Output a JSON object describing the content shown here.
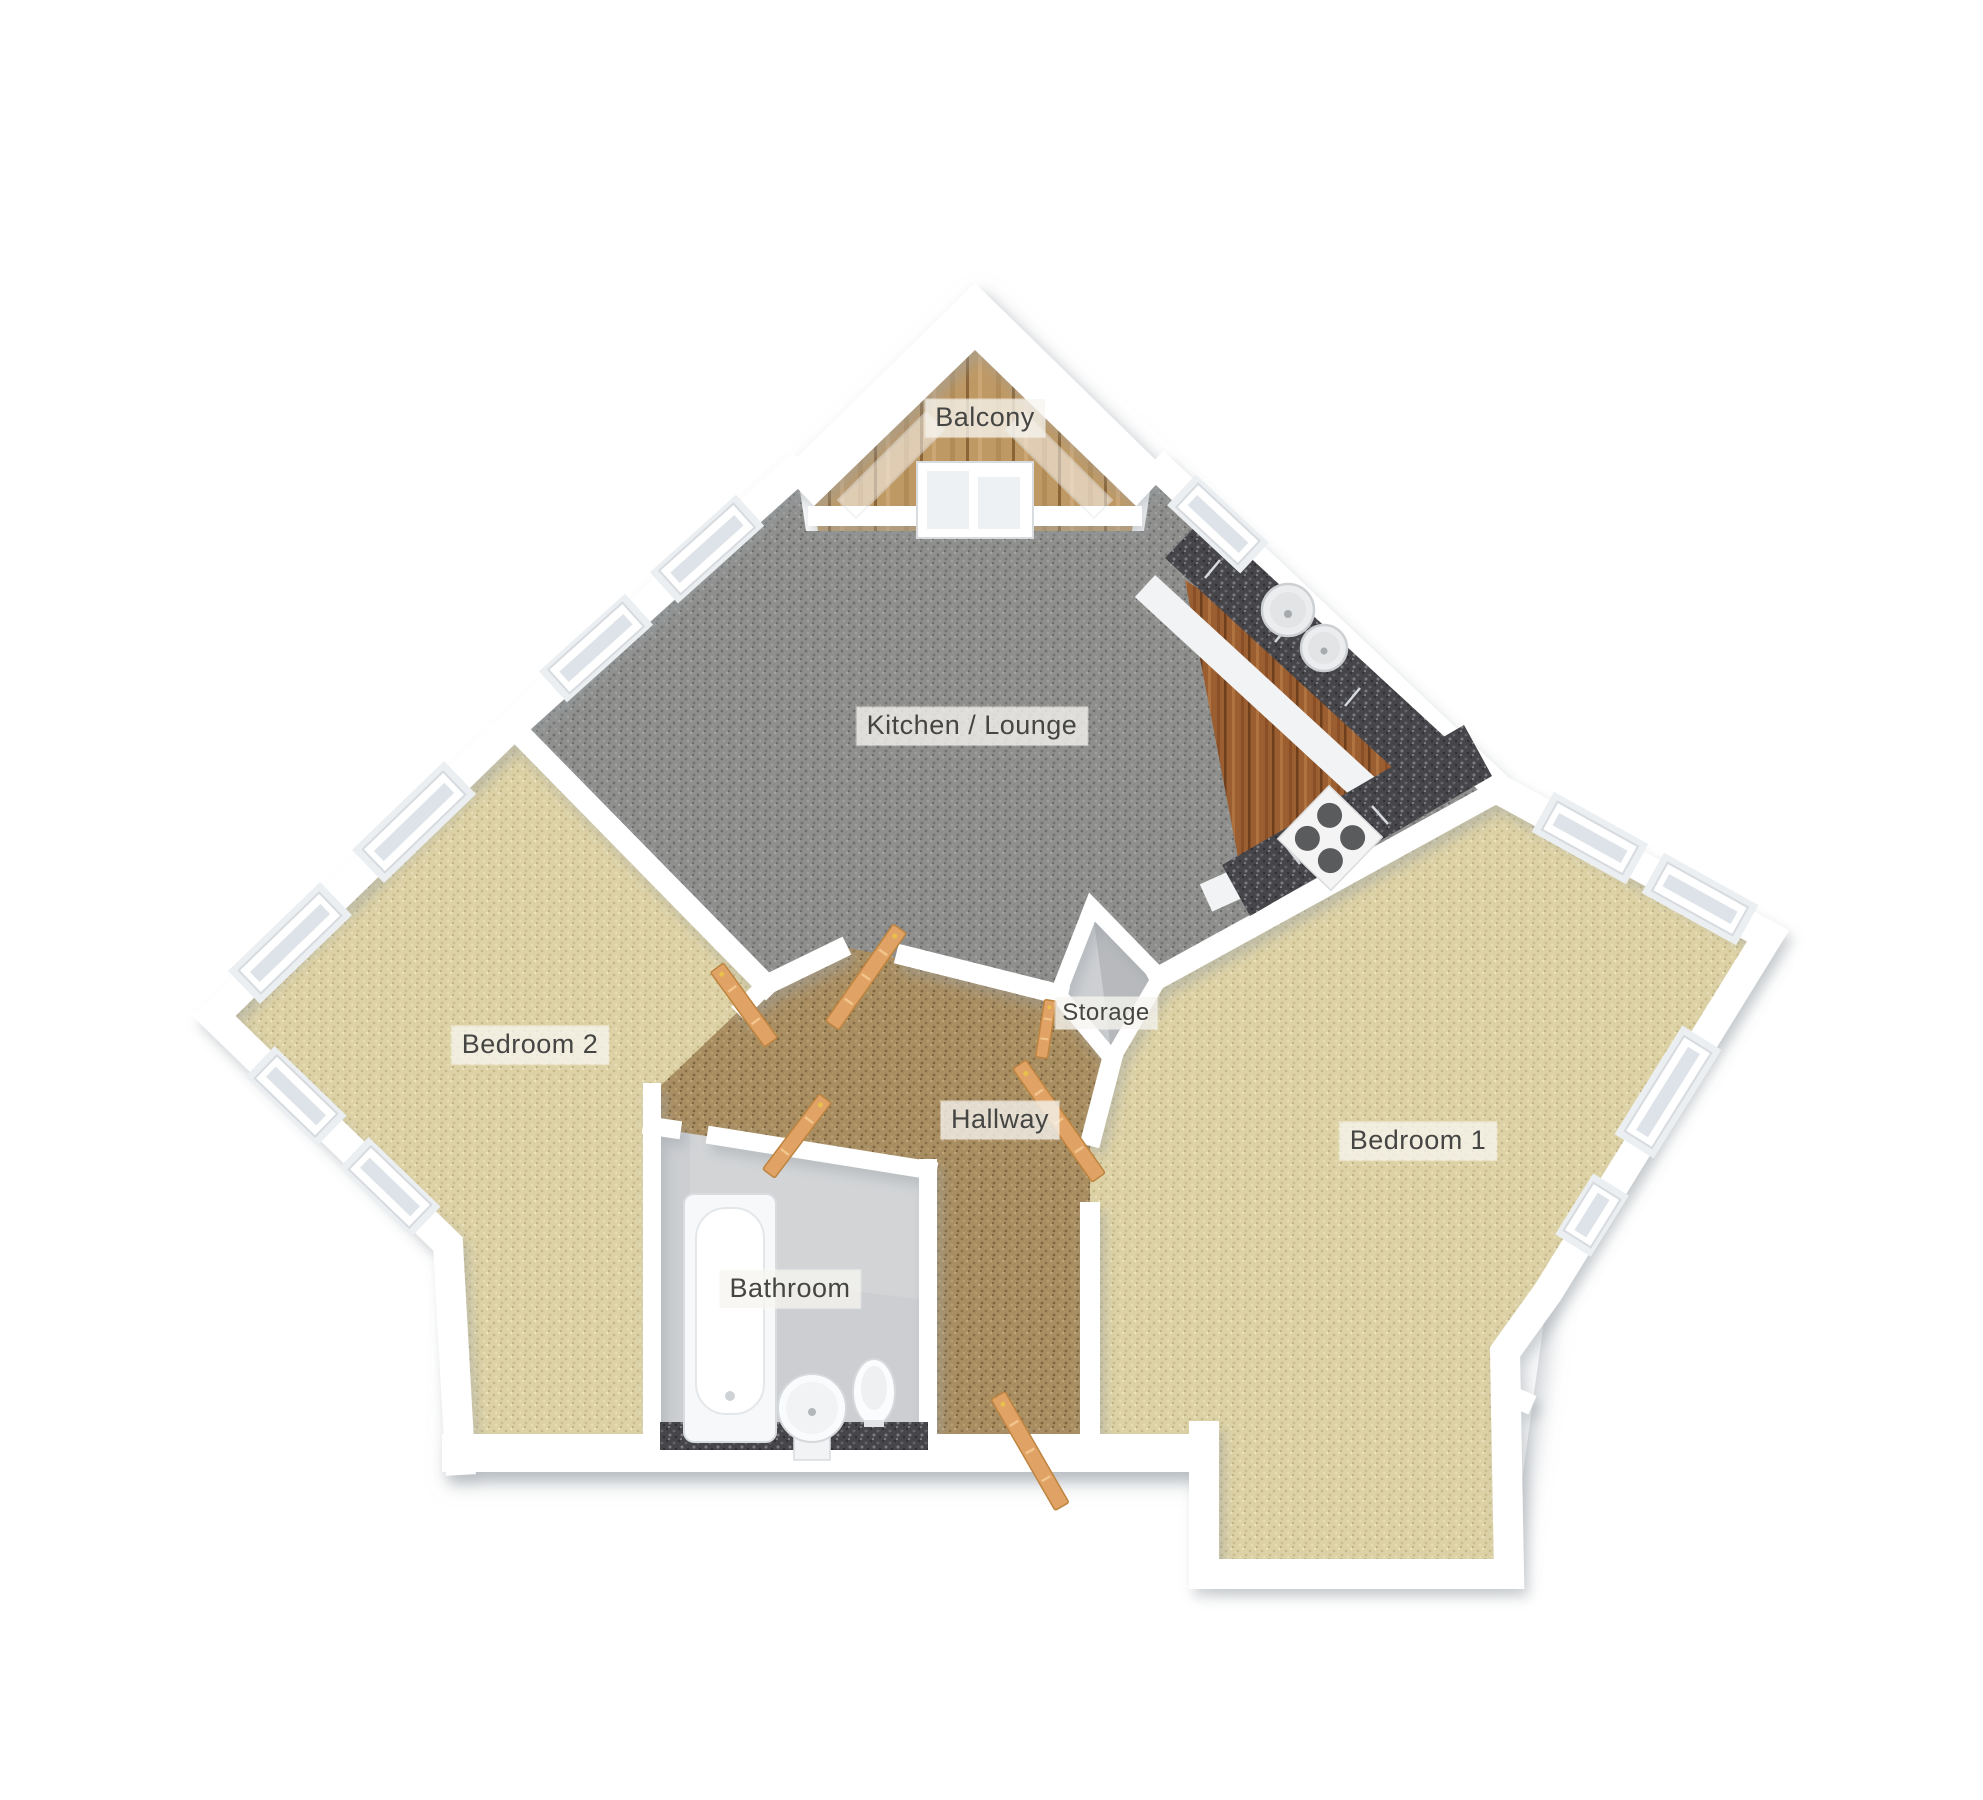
{
  "plan": {
    "type": "3d-floorplan",
    "rooms": {
      "balcony": {
        "label": "Balcony"
      },
      "kitchen_lounge": {
        "label": "Kitchen / Lounge"
      },
      "storage": {
        "label": "Storage"
      },
      "hallway": {
        "label": "Hallway"
      },
      "bedroom2": {
        "label": "Bedroom 2"
      },
      "bedroom1": {
        "label": "Bedroom 1"
      },
      "bathroom": {
        "label": "Bathroom"
      }
    },
    "colors": {
      "background": "#ffffff",
      "wall": "#ffffff",
      "wall_shadow": "#b9bec4",
      "carpet_lounge": "#8f8f8d",
      "carpet_bedroom": "#ddd2a6",
      "carpet_hallway": "#a98e62",
      "wood_balcony": "#bf9964",
      "wood_kitchen": "#9b5e31",
      "granite": "#46464a",
      "door": "#e0a265",
      "bathroom_floor": "#ccced1",
      "storage_floor": "#c5c7ca"
    }
  }
}
